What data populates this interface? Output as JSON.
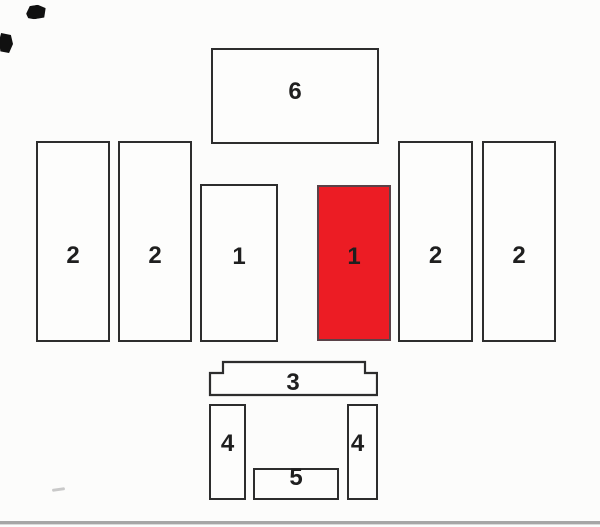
{
  "diagram": {
    "type": "parts-layout",
    "highlighted_piece_label": "1",
    "colors": {
      "highlight": "#ec1c24",
      "outline": "#2d2d2d",
      "label": "#1f1f1f",
      "baseline": "#a6a6a6",
      "background": "#fcfcfb"
    },
    "pieces": [
      {
        "id": "piece-6-top",
        "label": "6",
        "highlighted": false
      },
      {
        "id": "piece-2-far-left",
        "label": "2",
        "highlighted": false
      },
      {
        "id": "piece-2-left",
        "label": "2",
        "highlighted": false
      },
      {
        "id": "piece-1-left",
        "label": "1",
        "highlighted": false
      },
      {
        "id": "piece-1-right",
        "label": "1",
        "highlighted": true
      },
      {
        "id": "piece-2-right",
        "label": "2",
        "highlighted": false
      },
      {
        "id": "piece-2-far-right",
        "label": "2",
        "highlighted": false
      },
      {
        "id": "piece-3-bottom",
        "label": "3",
        "highlighted": false
      },
      {
        "id": "piece-4-left",
        "label": "4",
        "highlighted": false
      },
      {
        "id": "piece-4-right",
        "label": "4",
        "highlighted": false
      },
      {
        "id": "piece-5-bottom",
        "label": "5",
        "highlighted": false
      }
    ]
  }
}
